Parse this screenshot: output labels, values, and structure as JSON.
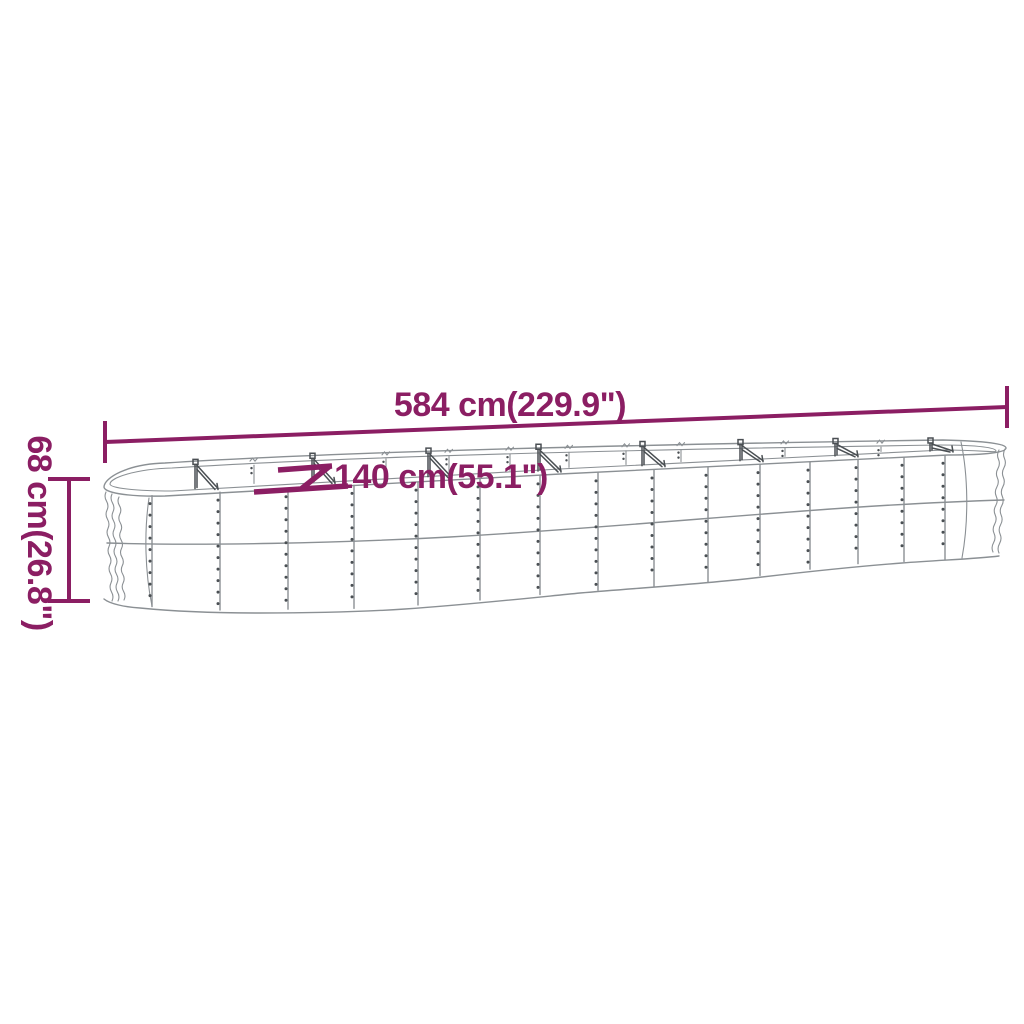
{
  "page": {
    "background": "#ffffff"
  },
  "diagram": {
    "type": "product-dimension-diagram",
    "subject": "oval corrugated steel raised garden bed (side view)",
    "accent_color": "#8B1E63",
    "drawing_color": "#8B9094",
    "detail_color": "#4A4F53",
    "dimensions": {
      "length": {
        "label": "584 cm(229.9\")",
        "cm": 584,
        "inches": 229.9
      },
      "width": {
        "label": "140 cm(55.1\")",
        "cm": 140,
        "inches": 55.1
      },
      "height": {
        "label": "68 cm(26.8\")",
        "cm": 68,
        "inches": 26.8
      }
    }
  }
}
